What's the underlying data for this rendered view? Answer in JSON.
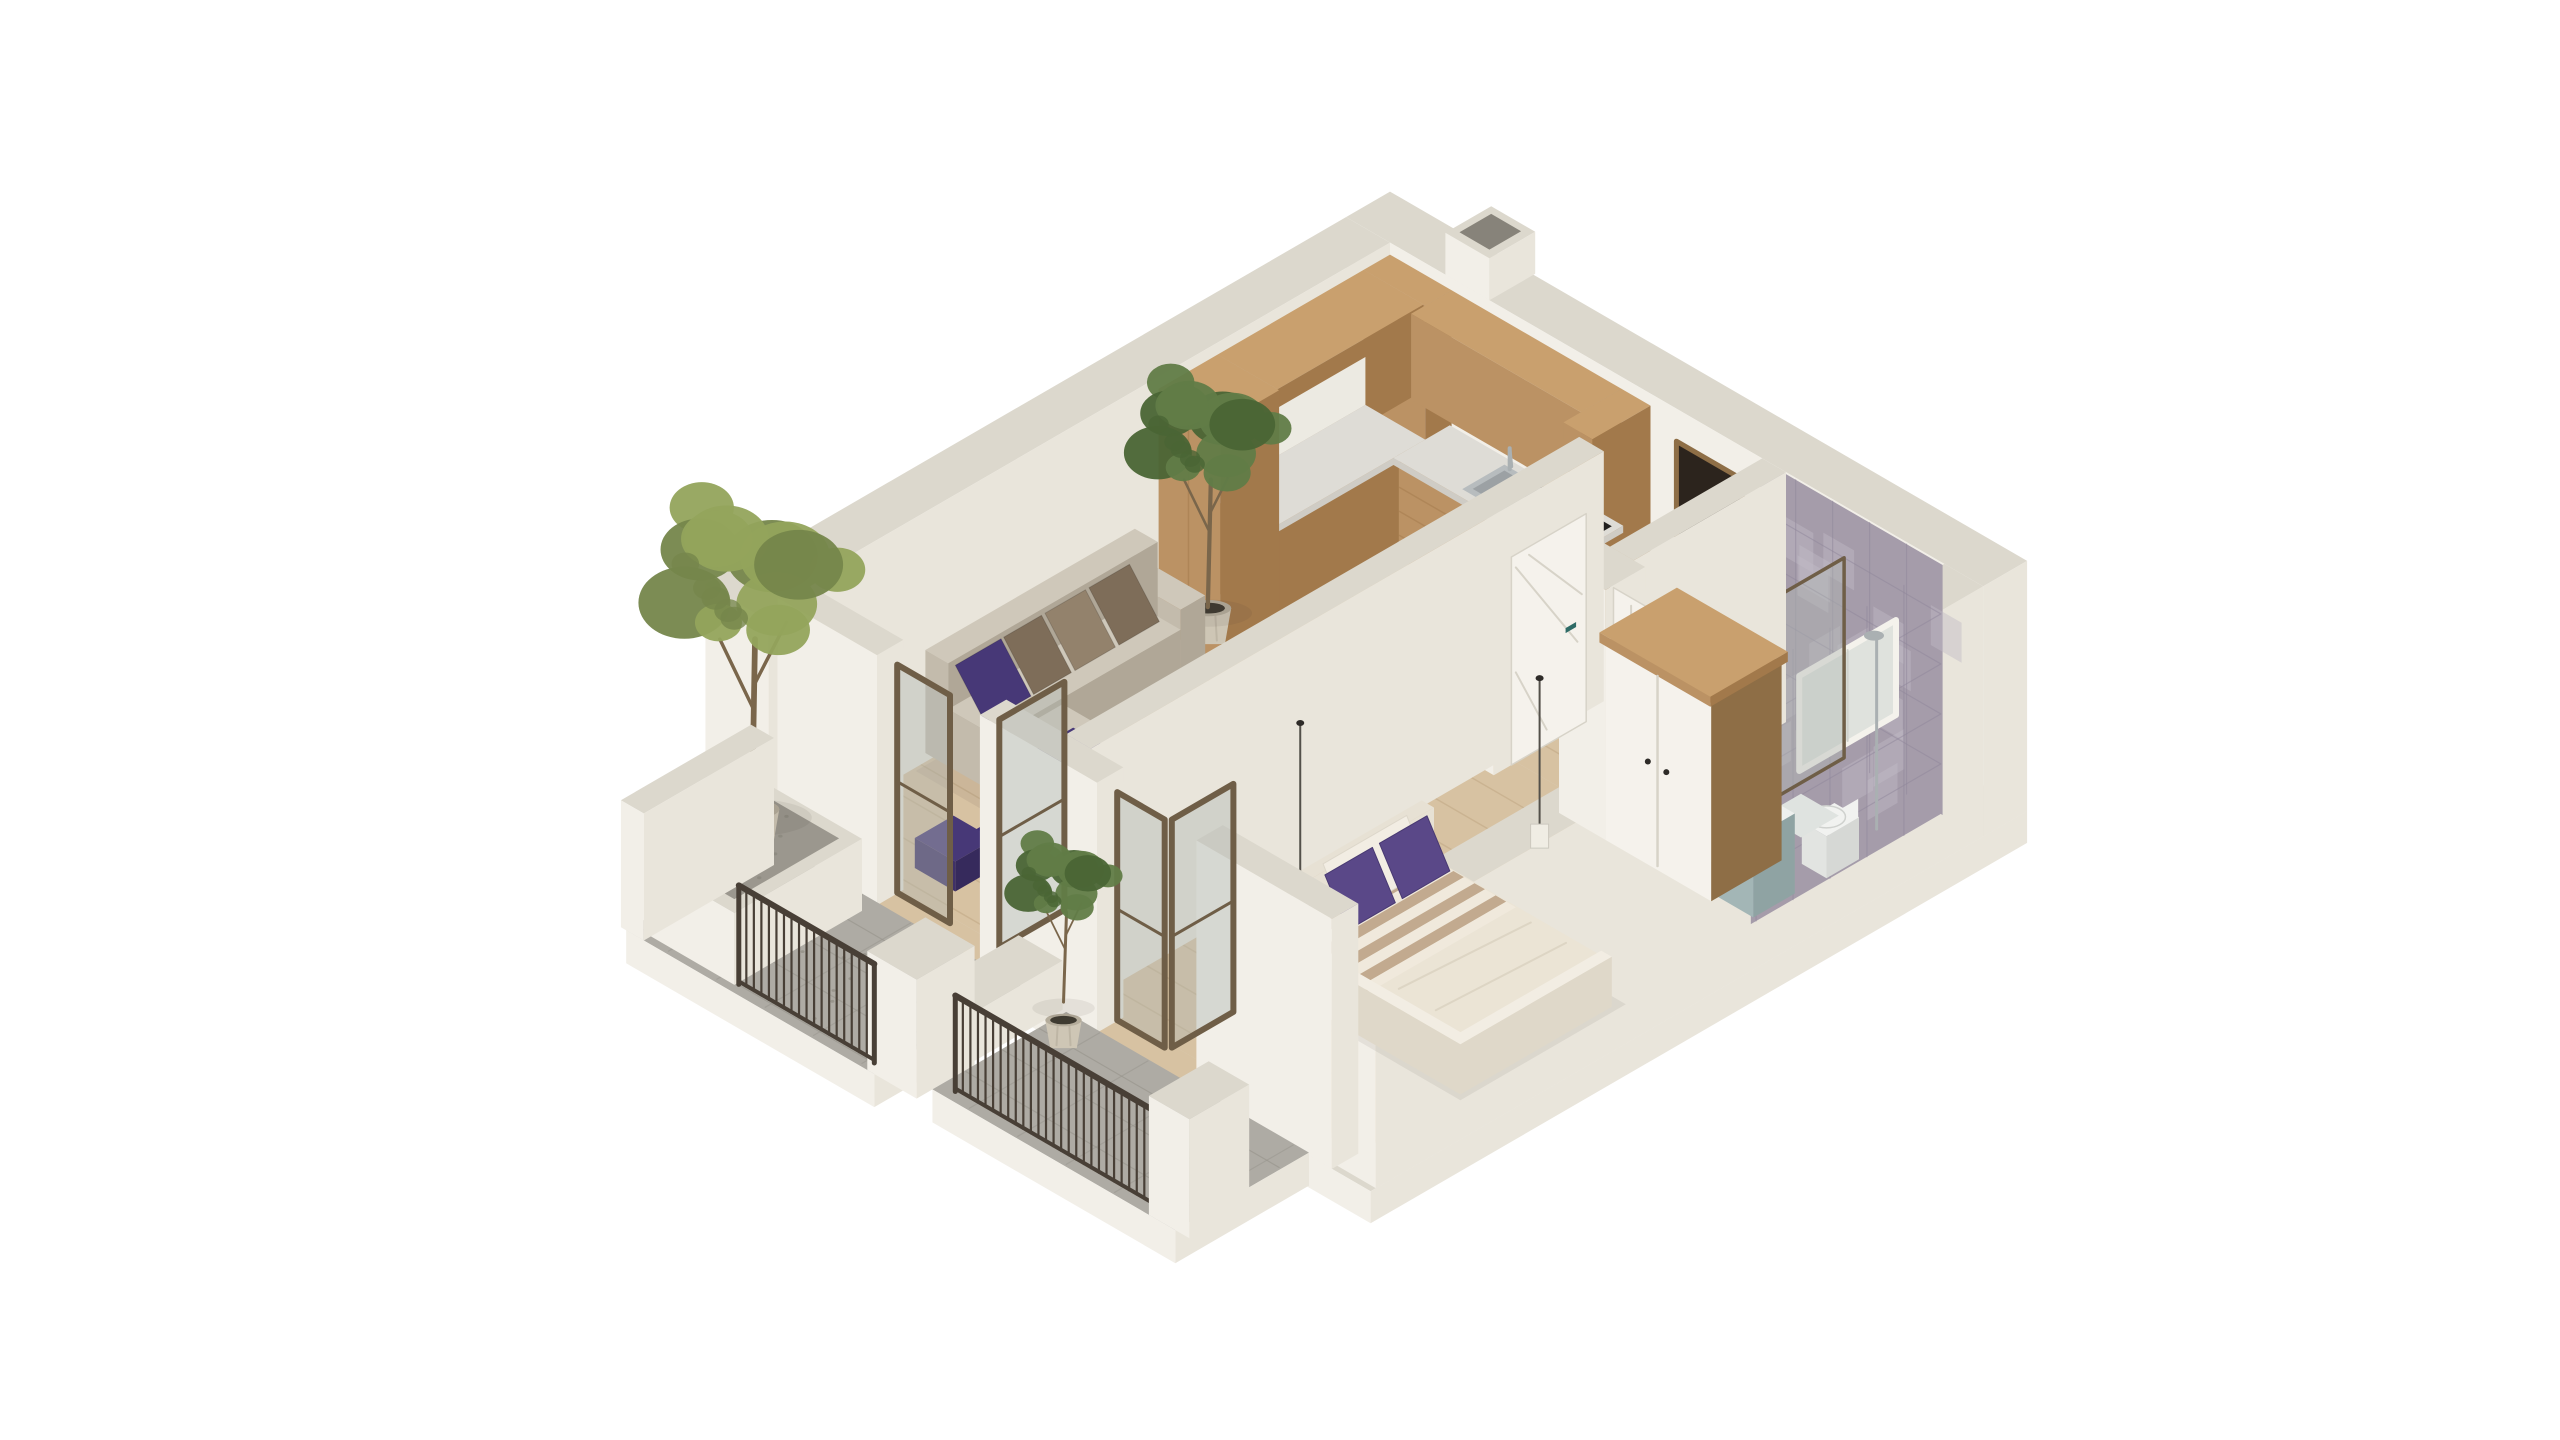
{
  "scene": {
    "type": "isometric-apartment-floorplan-render",
    "aria_label": "3D isometric cutaway render of a one-bedroom apartment with kitchen, living room, bedroom, bathroom and two balconies",
    "background": "#ffffff",
    "palette": {
      "wallL": "#f2efe8",
      "wallR": "#e9e5db",
      "wallTop": "#dcd8cd",
      "slabSide": "#efece4",
      "floorWood": "#d7c2a2",
      "plank": "#bfa582",
      "floorBath": "#9fadaa",
      "bathLine": "#8d9b98",
      "balcony": "#aeaba4",
      "balconyLine": "#98958d",
      "gravel": "#9b978e",
      "speck": "#868378",
      "cabL": "#bb9264",
      "cabR": "#a2794b",
      "cabTop": "#c9a06e",
      "counterTop": "#dedcd6",
      "counterSide": "#cfccc5",
      "splash": "#eceae2",
      "cooktop": "#211f1d",
      "sinkMetal": "#b7bcbe",
      "chrome": "#aab0b2",
      "applianceDark": "#27231f",
      "sofaTop": "#cfc8ba",
      "sofaL": "#c3bbac",
      "sofaR": "#b0a797",
      "cushBrown": "#7e6d59",
      "cushBrown2": "#93826c",
      "cushPurple": "#473877",
      "rug": "#3e2f75",
      "rugDark": "#312459",
      "marbleTop": "#edebe6",
      "marbleSide": "#dbd8d2",
      "vein": "#bcb8b1",
      "bedTop": "#ebe4d5",
      "bedSide": "#dfd8c9",
      "blanketA": "#c2aa8f",
      "blanketB": "#f0e9dc",
      "pillowPurple": "#5a4888",
      "pillowWhite": "#f2ede3",
      "headboard": "#e7e1d4",
      "woodTop": "#aa8b61",
      "woodSide": "#8e6e46",
      "doorDark": "#2c241d",
      "doorWhite": "#f5f2ec",
      "doorLine": "#d7d3c8",
      "handleDark": "#2e2b28",
      "handleTeal": "#2e6b66",
      "tile": "#a59caa",
      "tileLight": "#c2bac6",
      "tileGrout": "#90879b",
      "vanity": "#a3b6b6",
      "toilet": "#f1f2f0",
      "glass": "rgba(176,184,178,0.42)",
      "glassFrame": "#6f5e47",
      "rail": "#483f36",
      "leafOlive": "#94a45c",
      "leafOliveD": "#75864b",
      "leafGreen": "#617c47",
      "leafGreenD": "#4a6535",
      "trunk": "#7a664b",
      "pot": "#cec6b5",
      "potSide": "#b4ac9b",
      "soil": "#3f3b31",
      "lampShade": "#f0ede4",
      "cord": "#53504a",
      "shadow": "rgba(60,55,45,0.08)"
    },
    "objects": [
      "exterior-walls",
      "ventilation-shaft",
      "wood-floor",
      "bathroom-floor",
      "kitchen-cabinets",
      "kitchen-countertop",
      "kitchen-sink",
      "kitchen-faucet",
      "cooktop",
      "cutting-board",
      "entrance-door",
      "living-bedroom-partition",
      "bedroom-door",
      "bathroom-door",
      "wardrobe",
      "sofa",
      "throw-pillows",
      "area-rug",
      "coffee-table",
      "floor-cushion",
      "indoor-plant",
      "bed",
      "bed-blanket",
      "bed-pillows",
      "pendant-lamp-bedside",
      "pendant-lamp-wardrobe",
      "bathroom-tiled-walls",
      "bathroom-window",
      "shower-glass",
      "shower-column",
      "toilet",
      "vanity-sink",
      "bath-mat",
      "front-walls",
      "balcony-glass-door-living",
      "balcony-glass-door-bedroom",
      "living-balcony",
      "bedroom-balcony",
      "planter-tree",
      "balcony-plant",
      "balcony-railings",
      "parapet-pillars"
    ]
  }
}
